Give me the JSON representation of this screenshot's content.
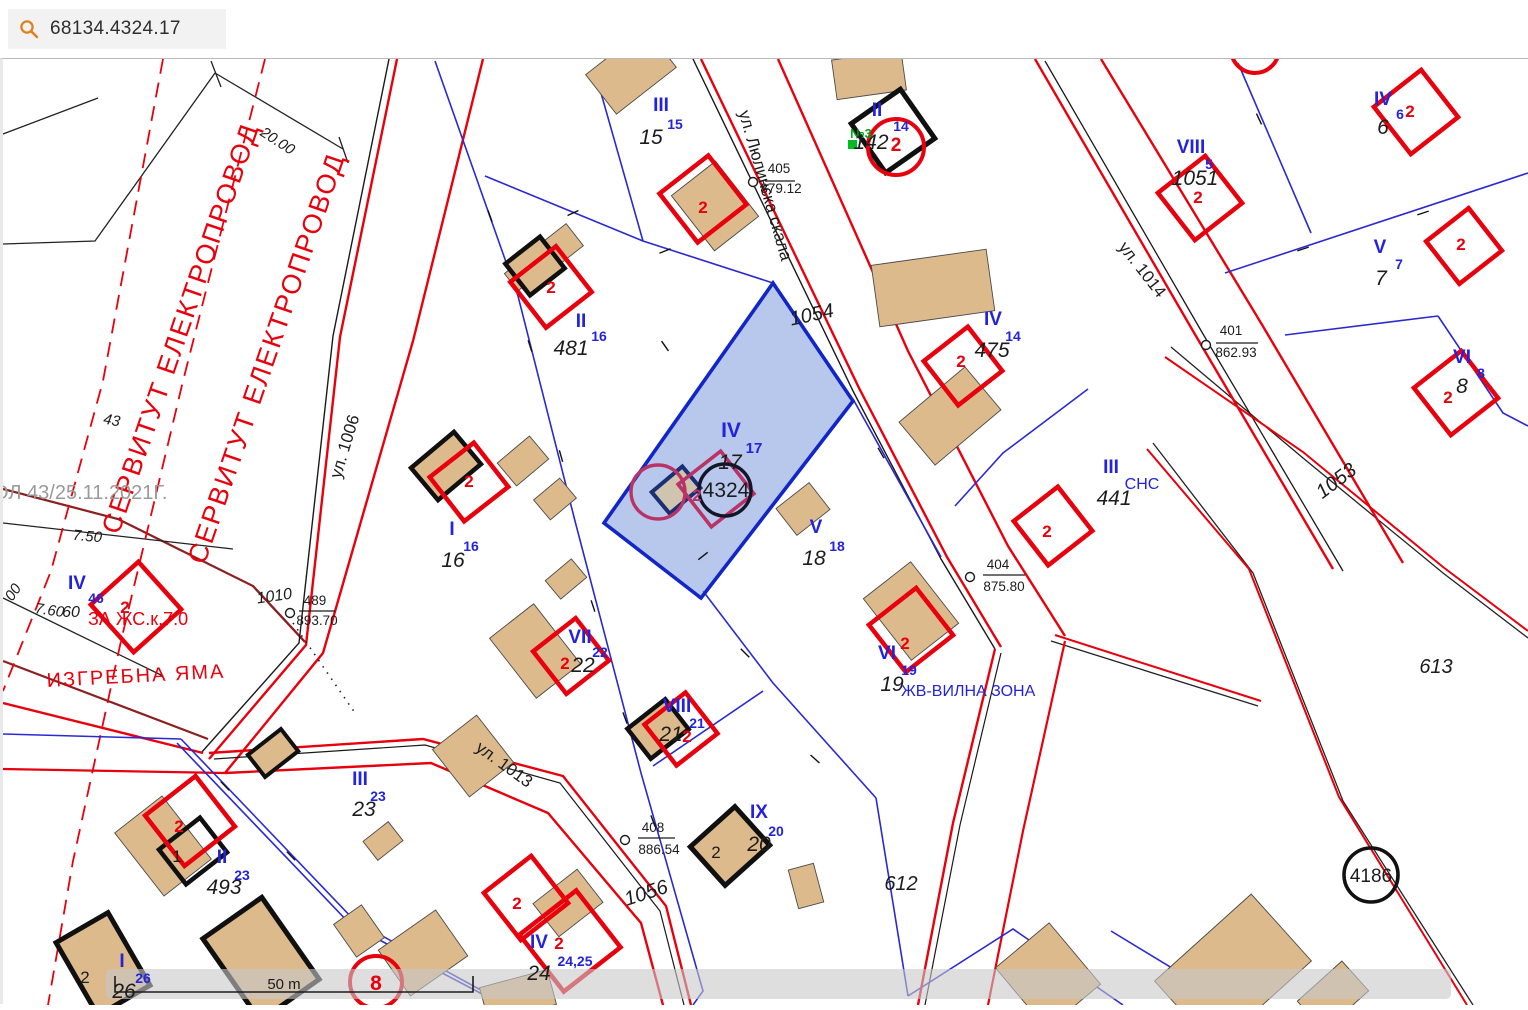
{
  "header": {
    "search_value": "68134.4324.17",
    "search_icon": "magnifier",
    "accent_orange": "#e0811f"
  },
  "scale_bar": {
    "label": "50 m"
  },
  "colors": {
    "regulation_red": "#e8000d",
    "cadastral_blue": "#2323dd",
    "selected_fill": "#8aa6e0",
    "selected_border": "#1226c8",
    "building_tan": "#dcba8c",
    "maroon_line": "#8b2020",
    "servitude_red": "#e8000d",
    "gray_text": "#9a9a9a",
    "green_marker": "#00a018",
    "crimson": "#b93366"
  },
  "map_labels": [
    {
      "n": "dim-label",
      "t": "20.00",
      "x": 272,
      "y": 86,
      "c": "#1c1c1c",
      "s": 15,
      "r": 33,
      "i": 1
    },
    {
      "n": "servitude-text",
      "t": "СЕРВИТУТ ЕЛЕКТРОПРОВОД",
      "x": 186,
      "y": 272,
      "c": "#e8000d",
      "s": 27,
      "r": -71,
      "sp": 2
    },
    {
      "n": "servitude-text",
      "t": "СЕРВИТУТ ЕЛЕКТРОПРОВОД",
      "x": 272,
      "y": 302,
      "c": "#e8000d",
      "s": 27,
      "r": -71,
      "sp": 2
    },
    {
      "n": "order-note",
      "t": "ОЛ 43/25.11.2021Г.",
      "x": -10,
      "y": 440,
      "c": "#9a9a9a",
      "s": 20,
      "a": "start"
    },
    {
      "n": "dim-label",
      "t": "43",
      "x": 108,
      "y": 366,
      "c": "#1c1c1c",
      "s": 15,
      "r": 10,
      "i": 1
    },
    {
      "n": "street-label",
      "t": "ул. 1006",
      "x": 347,
      "y": 389,
      "c": "#1c1c1c",
      "s": 17,
      "r": -73
    },
    {
      "n": "dim-label",
      "t": "7.50",
      "x": 84,
      "y": 482,
      "c": "#1c1c1c",
      "s": 15,
      "r": 5,
      "i": 1
    },
    {
      "n": "dim-label",
      "t": "00",
      "x": 14,
      "y": 536,
      "c": "#1c1c1c",
      "s": 15,
      "r": -55,
      "i": 1
    },
    {
      "n": "dim-label",
      "t": "7.60",
      "x": 46,
      "y": 556,
      "c": "#1c1c1c",
      "s": 15,
      "r": 8,
      "i": 1
    },
    {
      "n": "dim-label",
      "t": "60",
      "x": 68,
      "y": 558,
      "c": "#1c1c1c",
      "s": 16,
      "i": 1
    },
    {
      "n": "plot-roman",
      "t": "IV",
      "x": 74,
      "y": 530,
      "c": "#2323dd",
      "s": 19,
      "b": 1
    },
    {
      "n": "plot-sup",
      "t": "46",
      "x": 93,
      "y": 544,
      "c": "#2323dd",
      "s": 14,
      "b": 1
    },
    {
      "n": "building-num",
      "t": "2",
      "x": 122,
      "y": 554,
      "c": "#e8000d",
      "s": 17,
      "b": 1
    },
    {
      "n": "zone-label",
      "t": "ЗА ЖС.к.7.0",
      "x": 85,
      "y": 566,
      "c": "#e8000d",
      "s": 18,
      "a": "start"
    },
    {
      "n": "zone-label",
      "t": "ИЗГРЕБНА ЯМА",
      "x": 44,
      "y": 628,
      "c": "#e8000d",
      "s": 20,
      "r": -3,
      "a": "start",
      "sp": 2
    },
    {
      "n": "parcel-num",
      "t": "1010",
      "x": 272,
      "y": 542,
      "c": "#1c1c1c",
      "s": 16,
      "i": 1,
      "r": -8
    },
    {
      "n": "benchmark-top",
      "t": "489",
      "x": 312,
      "y": 546,
      "c": "#1c1c1c",
      "s": 13.5
    },
    {
      "n": "benchmark-bot",
      "t": "893.70",
      "x": 314,
      "y": 566,
      "c": "#1c1c1c",
      "s": 13.5
    },
    {
      "n": "street-label",
      "t": "ул. 1013",
      "x": 498,
      "y": 710,
      "c": "#1c1c1c",
      "s": 17,
      "r": 36
    },
    {
      "n": "street-label",
      "t": "ул. Люлинска скала",
      "x": 757,
      "y": 128,
      "c": "#1c1c1c",
      "s": 17,
      "r": 74
    },
    {
      "n": "benchmark-top",
      "t": "405",
      "x": 776,
      "y": 114,
      "c": "#1c1c1c",
      "s": 13.5
    },
    {
      "n": "benchmark-bot",
      "t": "879.12",
      "x": 778,
      "y": 134,
      "c": "#1c1c1c",
      "s": 13.5
    },
    {
      "n": "plot-roman",
      "t": "III",
      "x": 658,
      "y": 52,
      "c": "#2323dd",
      "s": 19,
      "b": 1
    },
    {
      "n": "plot-sup",
      "t": "15",
      "x": 672,
      "y": 70,
      "c": "#2323dd",
      "s": 14,
      "b": 1
    },
    {
      "n": "parcel-num",
      "t": "15",
      "x": 648,
      "y": 85,
      "c": "#1c1c1c",
      "s": 21,
      "i": 1
    },
    {
      "n": "building-num",
      "t": "2",
      "x": 700,
      "y": 154,
      "c": "#e8000d",
      "s": 17,
      "b": 1
    },
    {
      "n": "plot-roman",
      "t": "II",
      "x": 578,
      "y": 268,
      "c": "#2323dd",
      "s": 19,
      "b": 1
    },
    {
      "n": "plot-sup",
      "t": "16",
      "x": 596,
      "y": 282,
      "c": "#2323dd",
      "s": 14,
      "b": 1
    },
    {
      "n": "parcel-num",
      "t": "481",
      "x": 568,
      "y": 296,
      "c": "#1c1c1c",
      "s": 21,
      "i": 1
    },
    {
      "n": "building-num",
      "t": "2",
      "x": 548,
      "y": 234,
      "c": "#e8000d",
      "s": 17,
      "b": 1
    },
    {
      "n": "point-marker-label",
      "t": "№3",
      "x": 858,
      "y": 79,
      "c": "#00a018",
      "s": 13,
      "b": 1
    },
    {
      "n": "plot-roman",
      "t": "II",
      "x": 874,
      "y": 57,
      "c": "#2323dd",
      "s": 19,
      "b": 1
    },
    {
      "n": "plot-sup",
      "t": "14",
      "x": 898,
      "y": 72,
      "c": "#2323dd",
      "s": 14,
      "b": 1
    },
    {
      "n": "parcel-num",
      "t": "142",
      "x": 868,
      "y": 90,
      "c": "#1c1c1c",
      "s": 21,
      "i": 1
    },
    {
      "n": "building-num",
      "t": "2",
      "x": 893,
      "y": 92,
      "c": "#e8000d",
      "s": 19,
      "b": 1
    },
    {
      "n": "plot-roman",
      "t": "IV",
      "x": 1380,
      "y": 46,
      "c": "#2323dd",
      "s": 19,
      "b": 1
    },
    {
      "n": "plot-sup",
      "t": "6",
      "x": 1397,
      "y": 60,
      "c": "#2323dd",
      "s": 14,
      "b": 1
    },
    {
      "n": "building-num",
      "t": "2",
      "x": 1407,
      "y": 58,
      "c": "#e8000d",
      "s": 17,
      "b": 1
    },
    {
      "n": "parcel-num",
      "t": "6",
      "x": 1380,
      "y": 75,
      "c": "#1c1c1c",
      "s": 21,
      "i": 1
    },
    {
      "n": "plot-roman",
      "t": "VIII",
      "x": 1188,
      "y": 94,
      "c": "#2323dd",
      "s": 19,
      "b": 1
    },
    {
      "n": "plot-sup",
      "t": "5",
      "x": 1206,
      "y": 110,
      "c": "#2323dd",
      "s": 14,
      "b": 1
    },
    {
      "n": "parcel-num",
      "t": "1051",
      "x": 1192,
      "y": 126,
      "c": "#1c1c1c",
      "s": 21,
      "i": 1
    },
    {
      "n": "building-num",
      "t": "2",
      "x": 1195,
      "y": 144,
      "c": "#e8000d",
      "s": 17,
      "b": 1
    },
    {
      "n": "plot-roman",
      "t": "V",
      "x": 1377,
      "y": 194,
      "c": "#2323dd",
      "s": 19,
      "b": 1
    },
    {
      "n": "plot-sup",
      "t": "7",
      "x": 1396,
      "y": 210,
      "c": "#2323dd",
      "s": 14,
      "b": 1
    },
    {
      "n": "parcel-num",
      "t": "7",
      "x": 1378,
      "y": 226,
      "c": "#1c1c1c",
      "s": 21,
      "i": 1
    },
    {
      "n": "building-num",
      "t": "2",
      "x": 1458,
      "y": 191,
      "c": "#e8000d",
      "s": 17,
      "b": 1
    },
    {
      "n": "benchmark-top",
      "t": "401",
      "x": 1228,
      "y": 276,
      "c": "#1c1c1c",
      "s": 13.5
    },
    {
      "n": "benchmark-bot",
      "t": "862.93",
      "x": 1233,
      "y": 298,
      "c": "#1c1c1c",
      "s": 13.5
    },
    {
      "n": "street-label",
      "t": "ул. 1014",
      "x": 1135,
      "y": 214,
      "c": "#1c1c1c",
      "s": 17,
      "r": 52
    },
    {
      "n": "plot-roman",
      "t": "IV",
      "x": 990,
      "y": 266,
      "c": "#2323dd",
      "s": 19,
      "b": 1
    },
    {
      "n": "plot-sup",
      "t": "14",
      "x": 1010,
      "y": 282,
      "c": "#2323dd",
      "s": 14,
      "b": 1
    },
    {
      "n": "parcel-num",
      "t": "475",
      "x": 989,
      "y": 298,
      "c": "#1c1c1c",
      "s": 21,
      "i": 1
    },
    {
      "n": "building-num",
      "t": "2",
      "x": 958,
      "y": 308,
      "c": "#e8000d",
      "s": 17,
      "b": 1
    },
    {
      "n": "plot-roman",
      "t": "VI",
      "x": 1459,
      "y": 304,
      "c": "#2323dd",
      "s": 19,
      "b": 1
    },
    {
      "n": "plot-sup",
      "t": "8",
      "x": 1478,
      "y": 319,
      "c": "#2323dd",
      "s": 14,
      "b": 1
    },
    {
      "n": "parcel-num",
      "t": "8",
      "x": 1459,
      "y": 334,
      "c": "#1c1c1c",
      "s": 21,
      "i": 1
    },
    {
      "n": "building-num",
      "t": "2",
      "x": 1445,
      "y": 344,
      "c": "#e8000d",
      "s": 17,
      "b": 1
    },
    {
      "n": "parcel-num",
      "t": "1053",
      "x": 1337,
      "y": 427,
      "c": "#1c1c1c",
      "s": 20,
      "i": 1,
      "r": -37
    },
    {
      "n": "parcel-num",
      "t": "1054",
      "x": 810,
      "y": 262,
      "c": "#1c1c1c",
      "s": 20,
      "i": 1,
      "r": -12
    },
    {
      "n": "plot-roman",
      "t": "IV",
      "x": 728,
      "y": 378,
      "c": "#2323dd",
      "s": 21,
      "b": 1
    },
    {
      "n": "plot-sup",
      "t": "17",
      "x": 751,
      "y": 394,
      "c": "#2323dd",
      "s": 15,
      "b": 1
    },
    {
      "n": "parcel-num",
      "t": "17",
      "x": 727,
      "y": 410,
      "c": "#1c1c1c",
      "s": 21,
      "i": 1
    },
    {
      "n": "selected-parcel-num",
      "t": "4324",
      "x": 723,
      "y": 438,
      "c": "#1c1c1c",
      "s": 21
    },
    {
      "n": "building-num",
      "t": "2",
      "x": 694,
      "y": 442,
      "c": "#b93366",
      "s": 17,
      "b": 1
    },
    {
      "n": "plot-roman",
      "t": "V",
      "x": 813,
      "y": 474,
      "c": "#2323dd",
      "s": 19,
      "b": 1
    },
    {
      "n": "plot-sup",
      "t": "18",
      "x": 834,
      "y": 492,
      "c": "#2323dd",
      "s": 14,
      "b": 1
    },
    {
      "n": "parcel-num",
      "t": "18",
      "x": 811,
      "y": 506,
      "c": "#1c1c1c",
      "s": 21,
      "i": 1
    },
    {
      "n": "plot-roman",
      "t": "III",
      "x": 1108,
      "y": 414,
      "c": "#2323dd",
      "s": 19,
      "b": 1
    },
    {
      "n": "zone-label",
      "t": "СНС",
      "x": 1139,
      "y": 430,
      "c": "#2323dd",
      "s": 16
    },
    {
      "n": "parcel-num",
      "t": "441",
      "x": 1111,
      "y": 446,
      "c": "#1c1c1c",
      "s": 21,
      "i": 1
    },
    {
      "n": "building-num",
      "t": "2",
      "x": 1044,
      "y": 478,
      "c": "#e8000d",
      "s": 17,
      "b": 1
    },
    {
      "n": "parcel-num",
      "t": "613",
      "x": 1433,
      "y": 614,
      "c": "#1c1c1c",
      "s": 20,
      "i": 1
    },
    {
      "n": "benchmark-top",
      "t": "404",
      "x": 995,
      "y": 510,
      "c": "#1c1c1c",
      "s": 13.5
    },
    {
      "n": "benchmark-bot",
      "t": "875.80",
      "x": 1001,
      "y": 532,
      "c": "#1c1c1c",
      "s": 13.5
    },
    {
      "n": "plot-roman",
      "t": "VI",
      "x": 884,
      "y": 600,
      "c": "#2323dd",
      "s": 19,
      "b": 1
    },
    {
      "n": "building-num",
      "t": "2",
      "x": 902,
      "y": 590,
      "c": "#e8000d",
      "s": 17,
      "b": 1
    },
    {
      "n": "plot-sup",
      "t": "19",
      "x": 906,
      "y": 616,
      "c": "#2323dd",
      "s": 14,
      "b": 1
    },
    {
      "n": "parcel-num",
      "t": "19",
      "x": 889,
      "y": 632,
      "c": "#1c1c1c",
      "s": 21,
      "i": 1
    },
    {
      "n": "zone-label",
      "t": "ЖВ-ВИЛНА ЗОНА",
      "x": 898,
      "y": 637,
      "c": "#2323dd",
      "s": 16,
      "a": "start"
    },
    {
      "n": "plot-roman",
      "t": "I",
      "x": 449,
      "y": 476,
      "c": "#2323dd",
      "s": 19,
      "b": 1
    },
    {
      "n": "plot-sup",
      "t": "16",
      "x": 468,
      "y": 492,
      "c": "#2323dd",
      "s": 14,
      "b": 1
    },
    {
      "n": "parcel-num",
      "t": "16",
      "x": 450,
      "y": 508,
      "c": "#1c1c1c",
      "s": 21,
      "i": 1
    },
    {
      "n": "building-num",
      "t": "2",
      "x": 466,
      "y": 428,
      "c": "#e8000d",
      "s": 17,
      "b": 1
    },
    {
      "n": "plot-roman",
      "t": "VII",
      "x": 577,
      "y": 584,
      "c": "#2323dd",
      "s": 19,
      "b": 1
    },
    {
      "n": "plot-sup",
      "t": "22",
      "x": 597,
      "y": 598,
      "c": "#2323dd",
      "s": 14,
      "b": 1
    },
    {
      "n": "parcel-num",
      "t": "22",
      "x": 580,
      "y": 613,
      "c": "#1c1c1c",
      "s": 21,
      "i": 1
    },
    {
      "n": "building-num",
      "t": "2",
      "x": 562,
      "y": 610,
      "c": "#e8000d",
      "s": 17,
      "b": 1
    },
    {
      "n": "plot-roman",
      "t": "VIII",
      "x": 674,
      "y": 653,
      "c": "#2323dd",
      "s": 19,
      "b": 1
    },
    {
      "n": "plot-sup",
      "t": "21",
      "x": 694,
      "y": 669,
      "c": "#2323dd",
      "s": 14,
      "b": 1
    },
    {
      "n": "parcel-num",
      "t": "21",
      "x": 668,
      "y": 682,
      "c": "#1c1c1c",
      "s": 21,
      "i": 1
    },
    {
      "n": "building-num",
      "t": "2",
      "x": 684,
      "y": 683,
      "c": "#e8000d",
      "s": 17,
      "b": 1
    },
    {
      "n": "benchmark-top",
      "t": "408",
      "x": 650,
      "y": 773,
      "c": "#1c1c1c",
      "s": 13.5
    },
    {
      "n": "benchmark-bot",
      "t": "886.54",
      "x": 656,
      "y": 795,
      "c": "#1c1c1c",
      "s": 13.5
    },
    {
      "n": "plot-roman",
      "t": "IX",
      "x": 756,
      "y": 759,
      "c": "#2323dd",
      "s": 19,
      "b": 1
    },
    {
      "n": "plot-sup",
      "t": "20",
      "x": 773,
      "y": 777,
      "c": "#2323dd",
      "s": 14,
      "b": 1
    },
    {
      "n": "parcel-num",
      "t": "20",
      "x": 756,
      "y": 792,
      "c": "#1c1c1c",
      "s": 21,
      "i": 1
    },
    {
      "n": "building-num",
      "t": "2",
      "x": 713,
      "y": 799,
      "c": "#1c1c1c",
      "s": 17
    },
    {
      "n": "parcel-num",
      "t": "1056",
      "x": 645,
      "y": 840,
      "c": "#1c1c1c",
      "s": 20,
      "i": 1,
      "r": -18
    },
    {
      "n": "parcel-num",
      "t": "612",
      "x": 898,
      "y": 831,
      "c": "#1c1c1c",
      "s": 20,
      "i": 1
    },
    {
      "n": "plot-roman",
      "t": "III",
      "x": 357,
      "y": 726,
      "c": "#2323dd",
      "s": 19,
      "b": 1
    },
    {
      "n": "plot-sup",
      "t": "23",
      "x": 375,
      "y": 742,
      "c": "#2323dd",
      "s": 14,
      "b": 1
    },
    {
      "n": "parcel-num",
      "t": "23",
      "x": 361,
      "y": 757,
      "c": "#1c1c1c",
      "s": 21,
      "i": 1
    },
    {
      "n": "plot-roman",
      "t": "II",
      "x": 219,
      "y": 804,
      "c": "#2323dd",
      "s": 19,
      "b": 1
    },
    {
      "n": "plot-sup",
      "t": "23",
      "x": 239,
      "y": 821,
      "c": "#2323dd",
      "s": 14,
      "b": 1
    },
    {
      "n": "parcel-num",
      "t": "493",
      "x": 221,
      "y": 835,
      "c": "#1c1c1c",
      "s": 21,
      "i": 1
    },
    {
      "n": "building-num",
      "t": "2",
      "x": 176,
      "y": 773,
      "c": "#e8000d",
      "s": 17,
      "b": 1
    },
    {
      "n": "building-num",
      "t": "1",
      "x": 174,
      "y": 803,
      "c": "#1c1c1c",
      "s": 17
    },
    {
      "n": "plot-roman",
      "t": "IV",
      "x": 536,
      "y": 889,
      "c": "#2323dd",
      "s": 19,
      "b": 1
    },
    {
      "n": "building-num",
      "t": "2",
      "x": 556,
      "y": 890,
      "c": "#e8000d",
      "s": 17,
      "b": 1
    },
    {
      "n": "plot-sup",
      "t": "24,25",
      "x": 572,
      "y": 907,
      "c": "#2323dd",
      "s": 14,
      "b": 1
    },
    {
      "n": "parcel-num",
      "t": "24",
      "x": 536,
      "y": 921,
      "c": "#1c1c1c",
      "s": 21,
      "i": 1
    },
    {
      "n": "building-num",
      "t": "2",
      "x": 514,
      "y": 850,
      "c": "#e8000d",
      "s": 17,
      "b": 1
    },
    {
      "n": "building-num",
      "t": "8",
      "x": 373,
      "y": 931,
      "c": "#e8000d",
      "s": 21,
      "b": 1
    },
    {
      "n": "plot-roman",
      "t": "I",
      "x": 119,
      "y": 908,
      "c": "#2323dd",
      "s": 19,
      "b": 1
    },
    {
      "n": "plot-sup",
      "t": "26",
      "x": 140,
      "y": 924,
      "c": "#2323dd",
      "s": 14,
      "b": 1
    },
    {
      "n": "parcel-num",
      "t": "26",
      "x": 121,
      "y": 939,
      "c": "#1c1c1c",
      "s": 21,
      "i": 1
    },
    {
      "n": "building-num",
      "t": "2",
      "x": 82,
      "y": 924,
      "c": "#1c1c1c",
      "s": 17
    },
    {
      "n": "landmark-num",
      "t": "4186",
      "x": 1368,
      "y": 823,
      "c": "#1c1c1c",
      "s": 19
    },
    {
      "n": "scale-label",
      "t": "50 m",
      "x": 281,
      "y": 930,
      "c": "#1c1c1c",
      "s": 15
    }
  ]
}
